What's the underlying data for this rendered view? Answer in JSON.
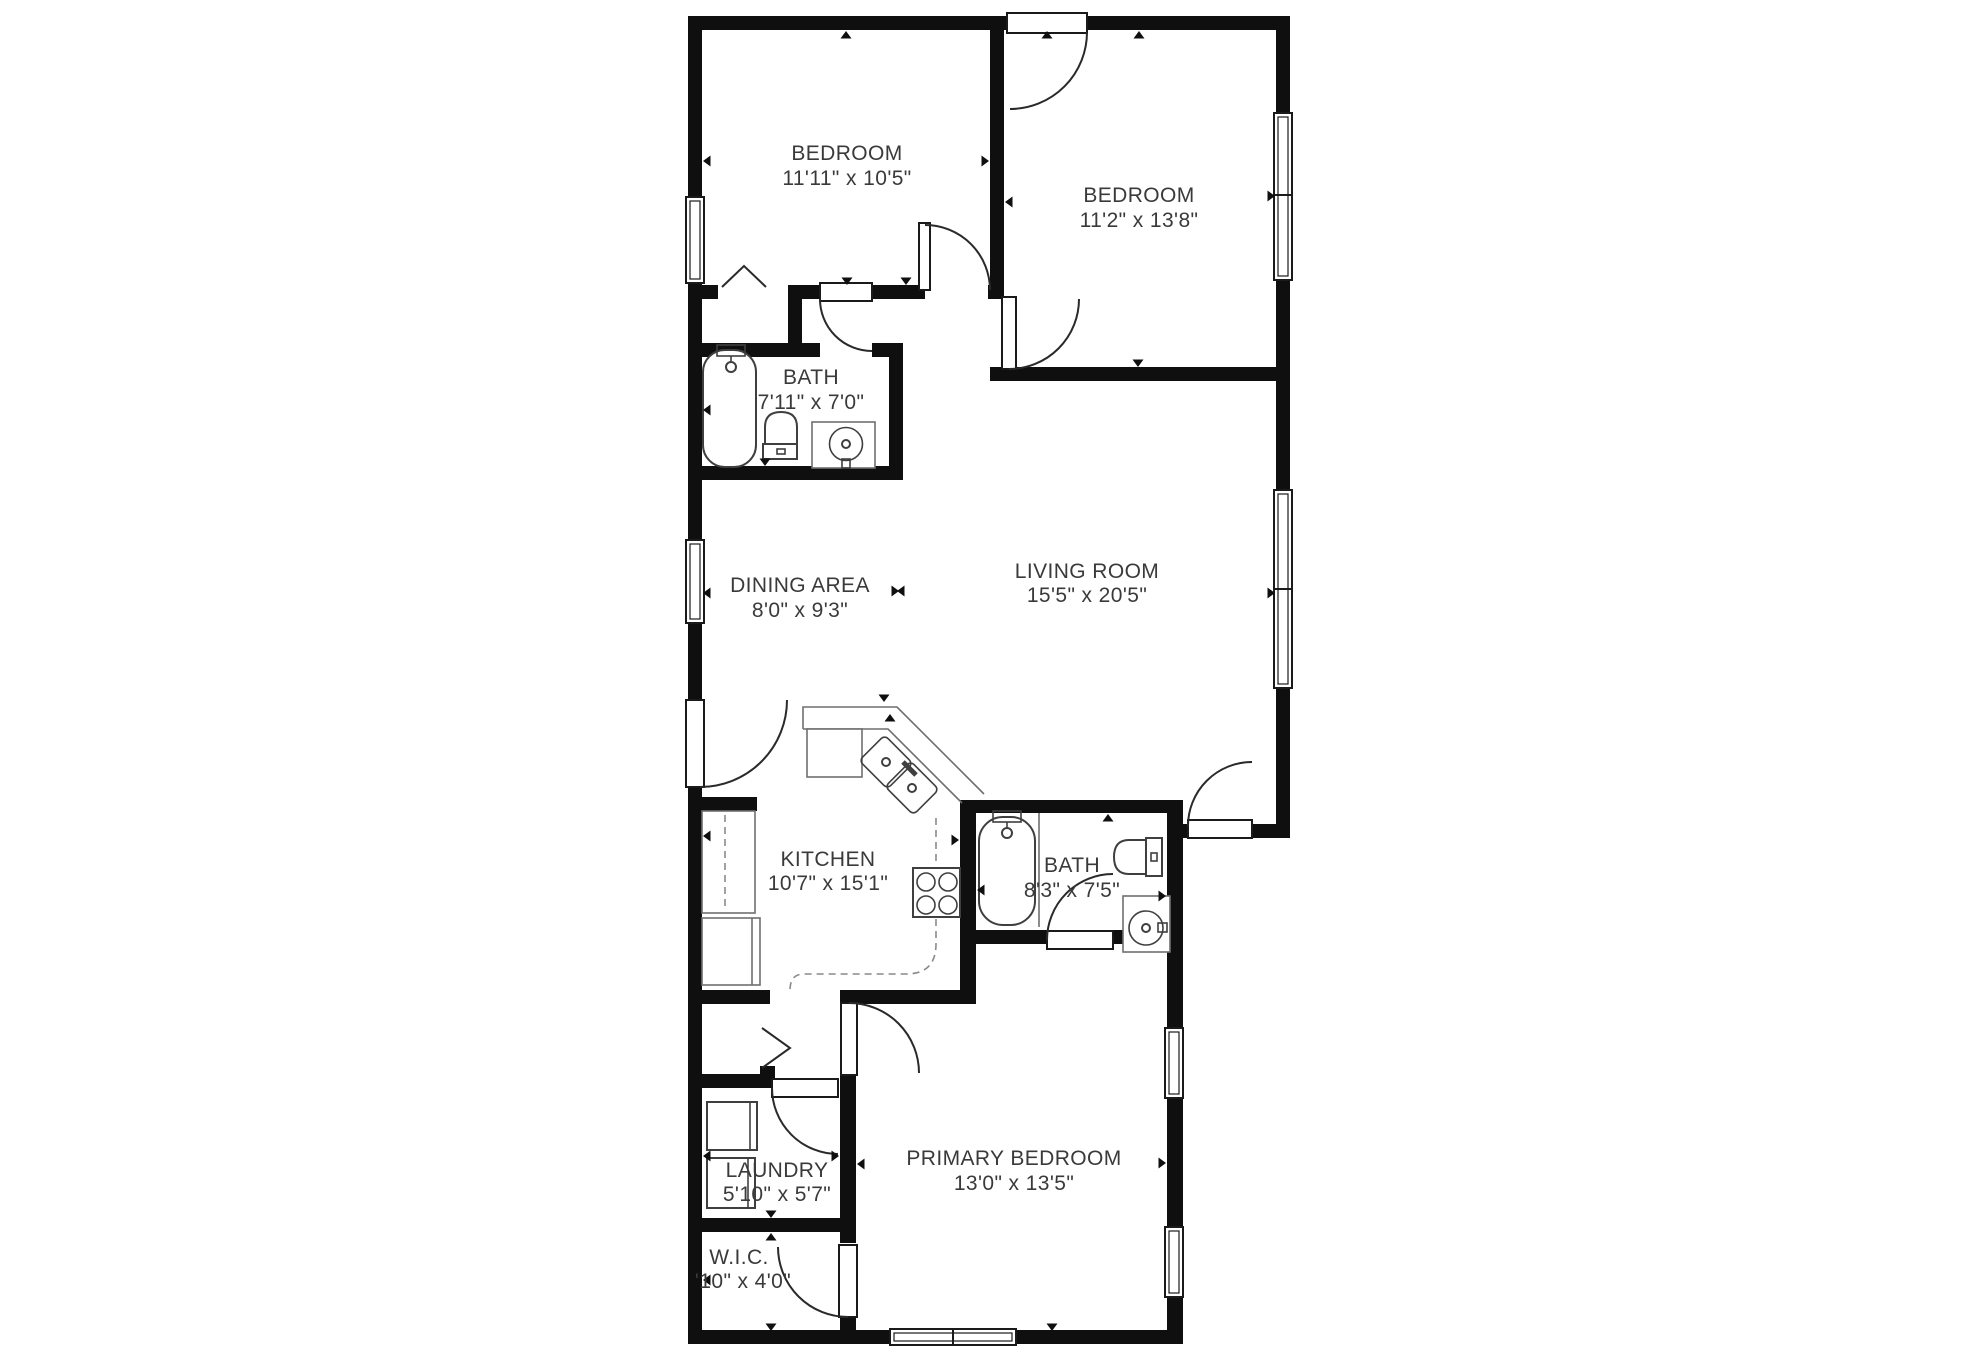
{
  "plan": {
    "background": "#ffffff",
    "wall_color": "#0f0f0f",
    "fixture_line_color": "#3f3f3f",
    "counter_line_color": "#6f6f6f",
    "label_color": "#3a3a3a",
    "rooms": [
      {
        "id": "bedroom-1",
        "name": "BEDROOM",
        "dims": "11'11\" x 10'5\""
      },
      {
        "id": "bedroom-2",
        "name": "BEDROOM",
        "dims": "11'2\" x 13'8\""
      },
      {
        "id": "bath-1",
        "name": "BATH",
        "dims": "7'11\" x 7'0\""
      },
      {
        "id": "dining",
        "name": "DINING AREA",
        "dims": "8'0\" x 9'3\""
      },
      {
        "id": "living",
        "name": "LIVING ROOM",
        "dims": "15'5\" x 20'5\""
      },
      {
        "id": "kitchen",
        "name": "KITCHEN",
        "dims": "10'7\" x 15'1\""
      },
      {
        "id": "bath-2",
        "name": "BATH",
        "dims": "8'3\" x 7'5\""
      },
      {
        "id": "laundry",
        "name": "LAUNDRY",
        "dims": "5'10\" x 5'7\""
      },
      {
        "id": "wic",
        "name": "W.I.C.",
        "dims": "'10\" x 4'0\""
      },
      {
        "id": "primary",
        "name": "PRIMARY BEDROOM",
        "dims": "13'0\" x 13'5\""
      }
    ],
    "fixtures": {
      "bath_1": [
        "bathtub",
        "toilet",
        "sink-vanity"
      ],
      "bath_2": [
        "bathtub",
        "toilet",
        "sink-vanity"
      ],
      "kitchen": [
        "counter",
        "double-sink",
        "stove",
        "upper-cabinets-dashed"
      ],
      "laundry": [
        "washer",
        "dryer"
      ],
      "bedroom_1": [
        "closet-bifold-door"
      ],
      "hall": [
        "closet-bifold-door"
      ]
    }
  }
}
